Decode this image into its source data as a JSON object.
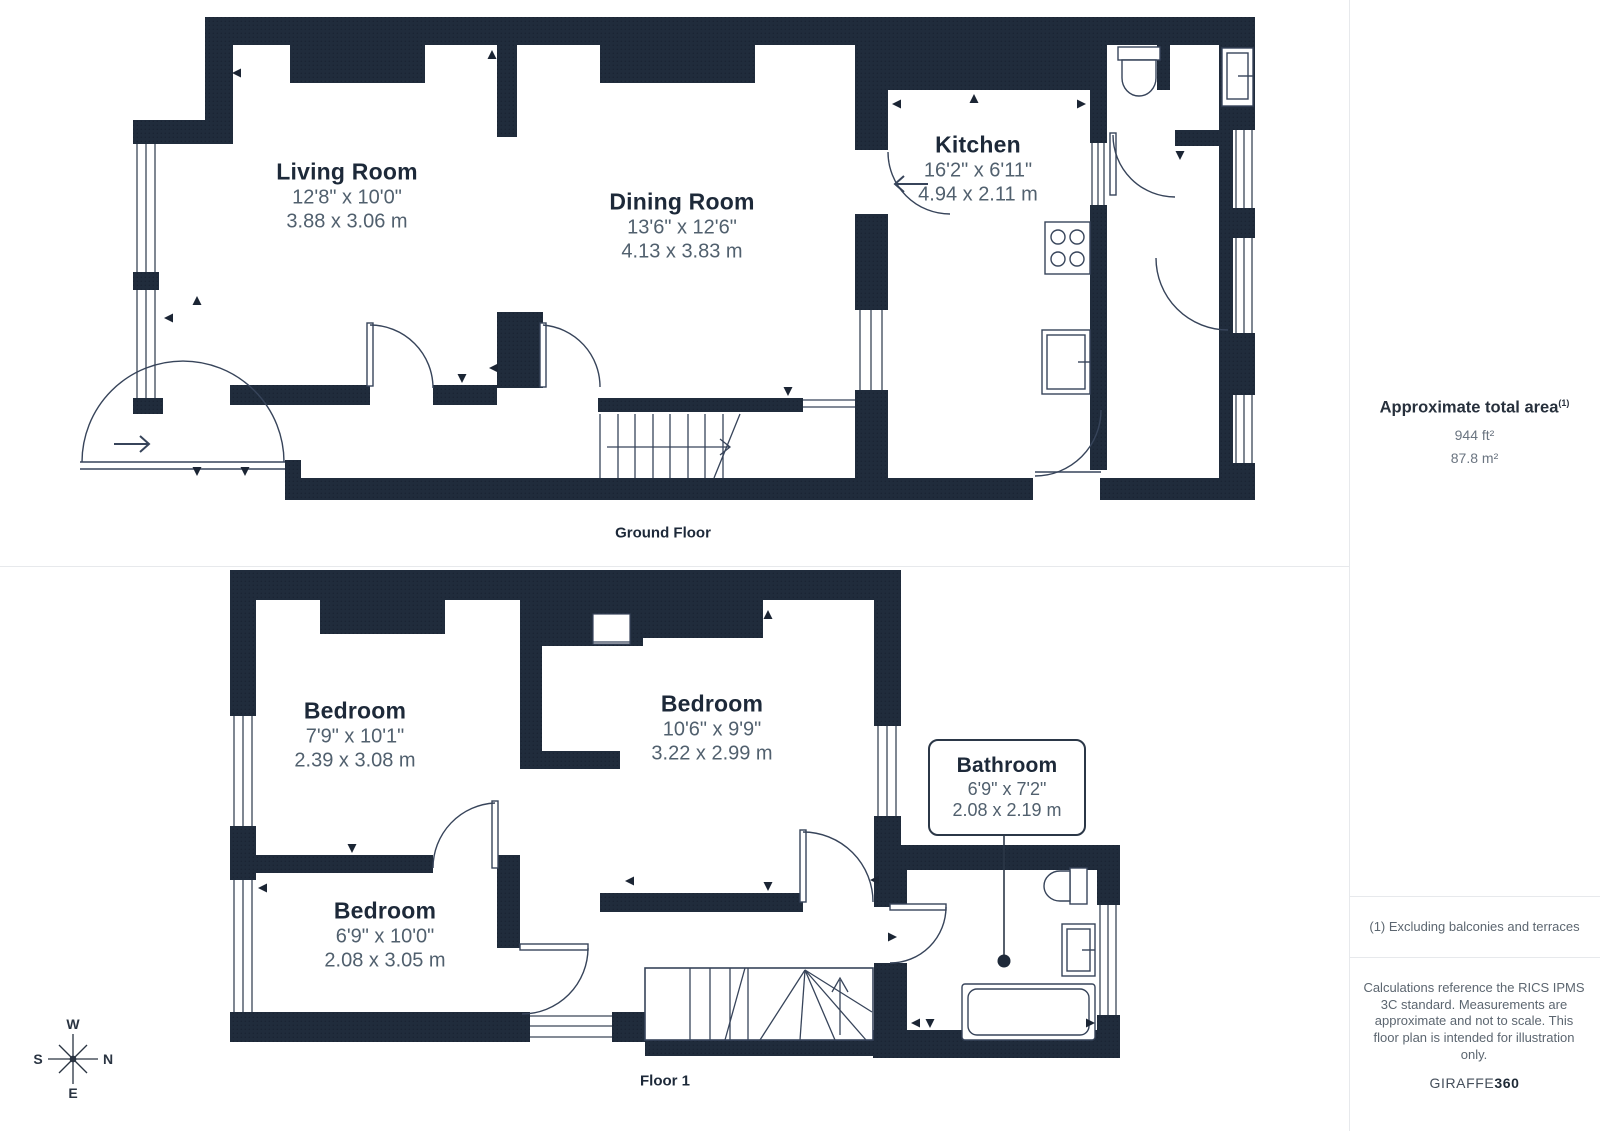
{
  "ground_floor": {
    "label": "Ground Floor",
    "rooms": [
      {
        "name": "Living Room",
        "imperial": "12'8\" x 10'0\"",
        "metric": "3.88 x 3.06 m"
      },
      {
        "name": "Dining Room",
        "imperial": "13'6\" x 12'6\"",
        "metric": "4.13 x 3.83 m"
      },
      {
        "name": "Kitchen",
        "imperial": "16'2\" x 6'11\"",
        "metric": "4.94 x 2.11 m"
      }
    ]
  },
  "floor_1": {
    "label": "Floor 1",
    "rooms": [
      {
        "name": "Bedroom",
        "imperial": "7'9\" x 10'1\"",
        "metric": "2.39 x 3.08 m"
      },
      {
        "name": "Bedroom",
        "imperial": "10'6\" x 9'9\"",
        "metric": "3.22 x 2.99 m"
      },
      {
        "name": "Bedroom",
        "imperial": "6'9\" x 10'0\"",
        "metric": "2.08 x 3.05 m"
      },
      {
        "name": "Bathroom",
        "imperial": "6'9\" x 7'2\"",
        "metric": "2.08 x 2.19 m"
      }
    ]
  },
  "sidebar": {
    "total_area_title": "Approximate total area",
    "total_area_superscript": "(1)",
    "total_area_ft": "944 ft²",
    "total_area_m": "87.8 m²",
    "footnote": "(1) Excluding balconies and terraces",
    "disclaimer": "Calculations reference the RICS IPMS 3C standard. Measurements are approximate and not to scale. This floor plan is intended for illustration only.",
    "brand_name": "GIRAFFE",
    "brand_suffix": "360"
  },
  "compass": {
    "north": "N",
    "south": "S",
    "east": "E",
    "west": "W"
  },
  "colors": {
    "wall": "#202c3c",
    "line": "#33405280",
    "accent": "#2b3747"
  }
}
